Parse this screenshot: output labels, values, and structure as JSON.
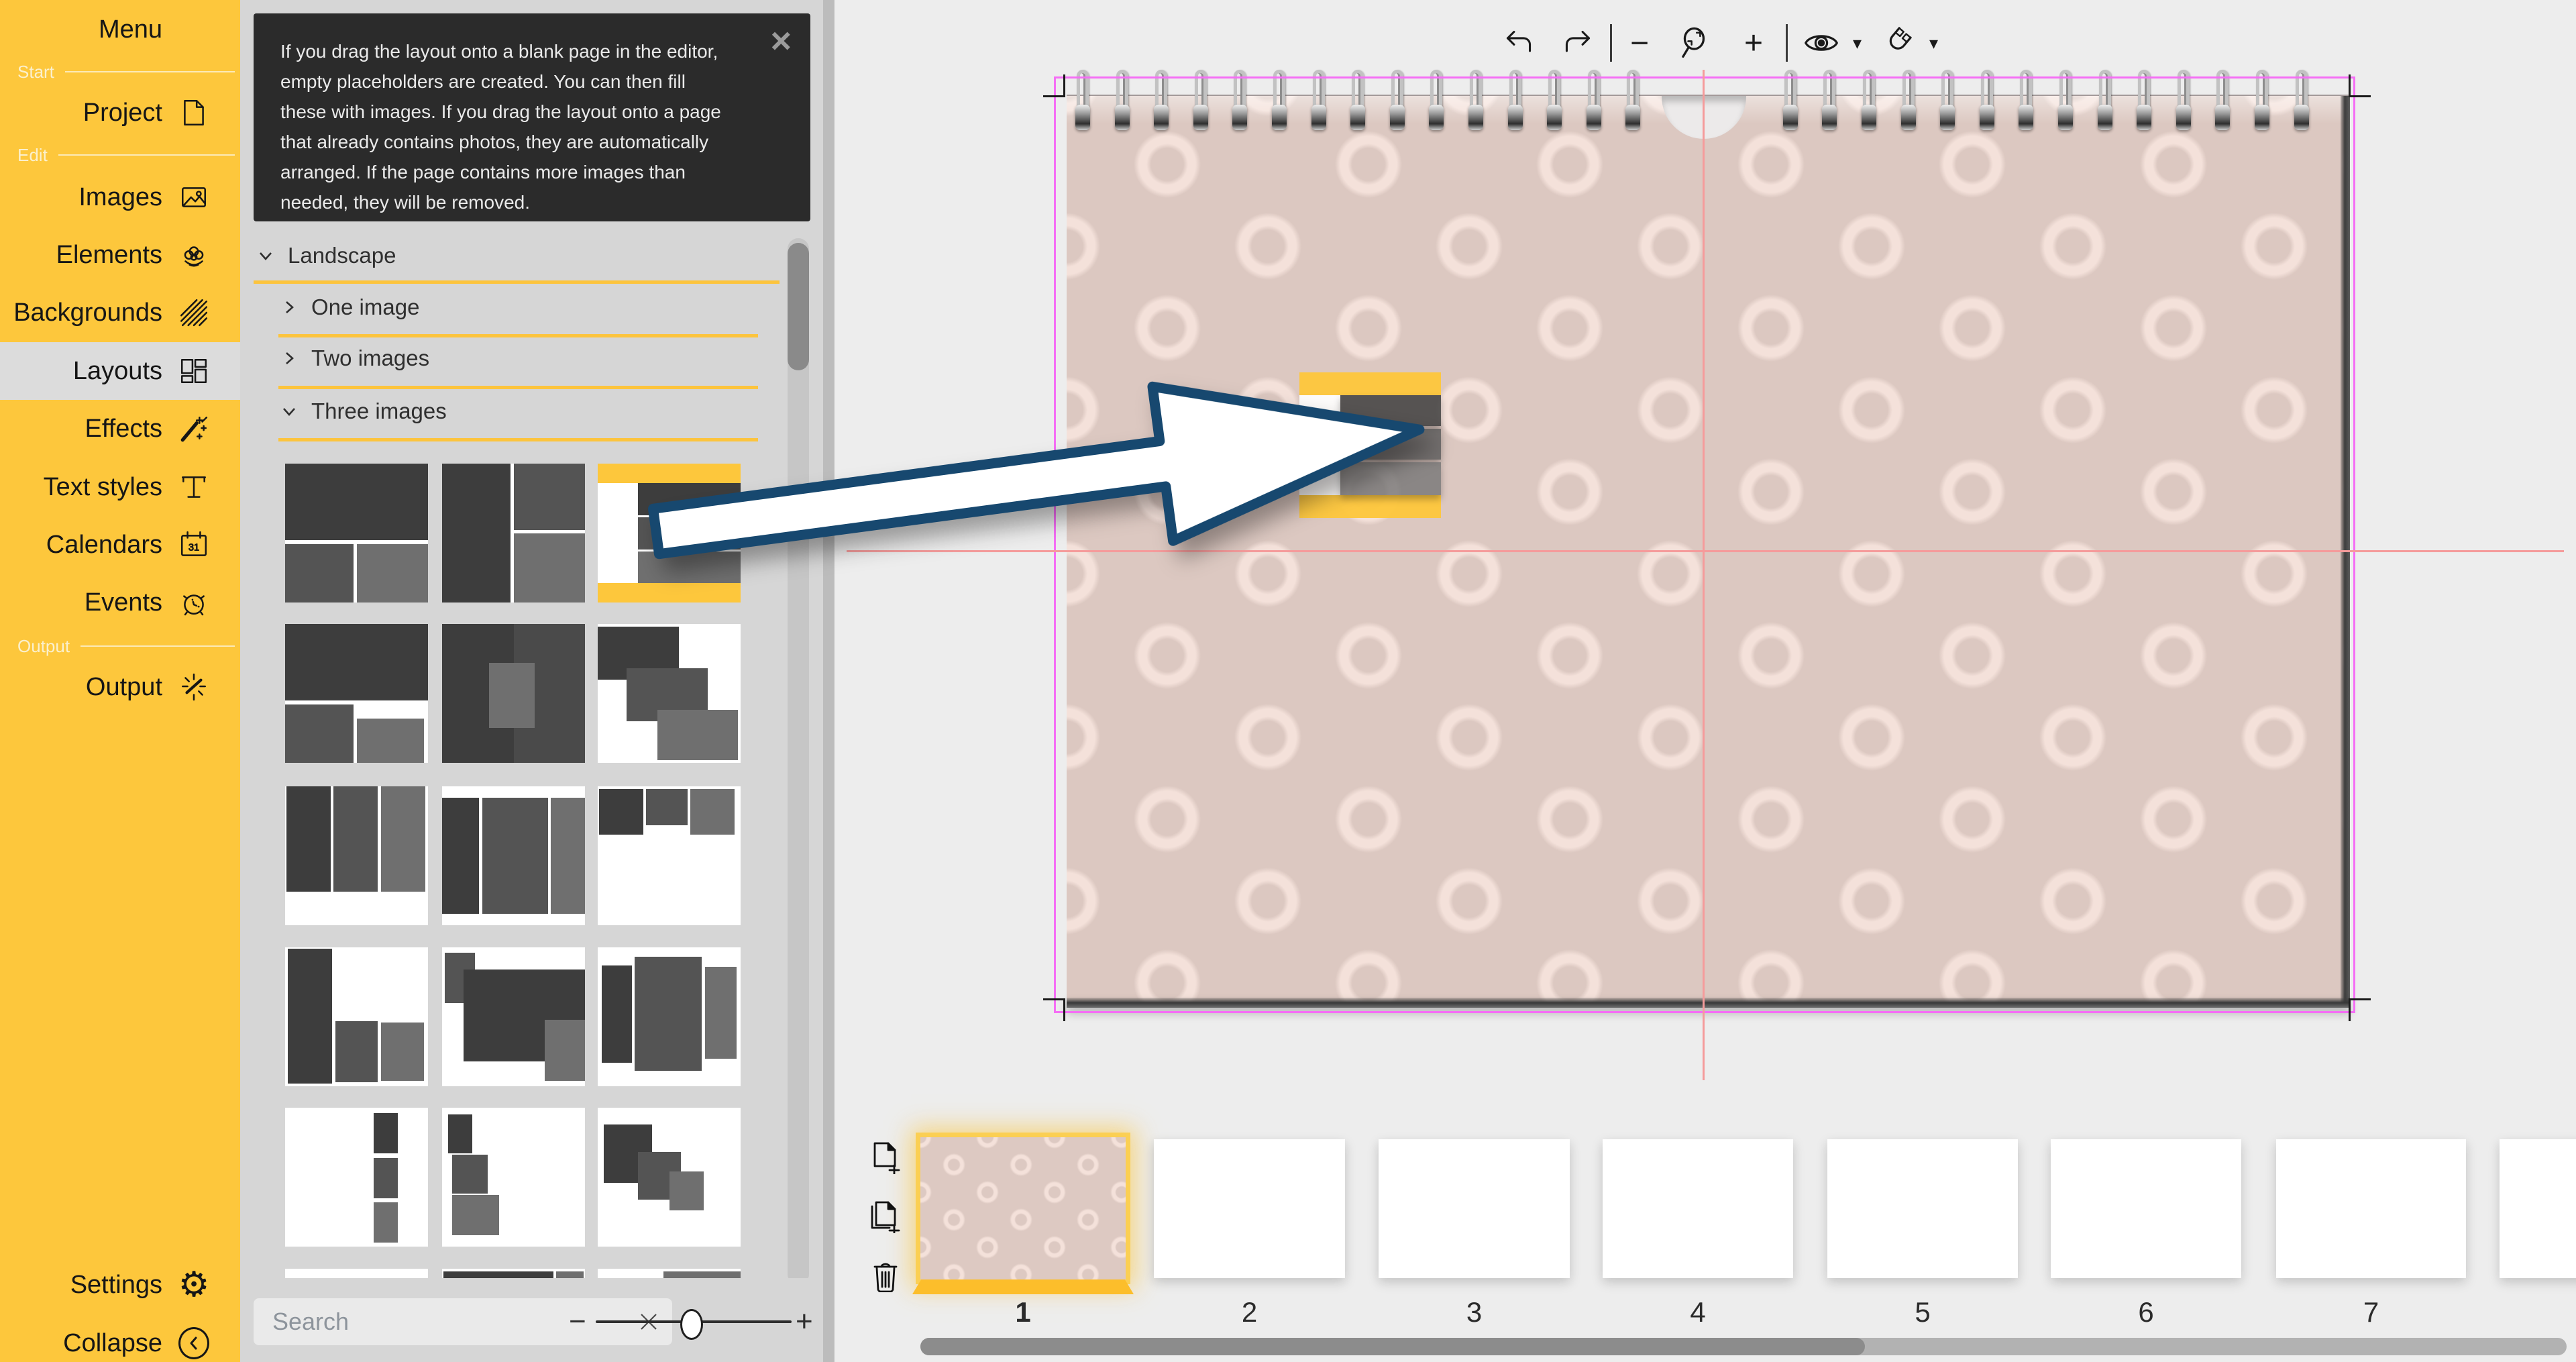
{
  "sidebar": {
    "menu": {
      "label": "Menu"
    },
    "sections": {
      "start": "Start",
      "edit": "Edit",
      "output": "Output"
    },
    "items": [
      {
        "label": "Project",
        "icon": "document-icon"
      },
      {
        "label": "Images",
        "icon": "image-icon"
      },
      {
        "label": "Elements",
        "icon": "flower-icon"
      },
      {
        "label": "Backgrounds",
        "icon": "hatch-icon"
      },
      {
        "label": "Layouts",
        "icon": "layout-grid-icon",
        "selected": true
      },
      {
        "label": "Effects",
        "icon": "magic-wand-icon"
      },
      {
        "label": "Text styles",
        "icon": "serif-t-icon"
      },
      {
        "label": "Calendars",
        "icon": "calendar-icon"
      },
      {
        "label": "Events",
        "icon": "alarm-clock-icon"
      },
      {
        "label": "Output",
        "icon": "spark-icon"
      }
    ],
    "footer": [
      {
        "label": "Settings",
        "icon": "gear-icon"
      },
      {
        "label": "Collapse",
        "icon": "collapse-icon"
      }
    ],
    "accent_color": "#fdc73c"
  },
  "tooltip": {
    "text": "If you drag the layout onto a blank page in the editor, empty placeholders are created. You can then fill these with images. If you drag the layout onto a page that already contains photos, they are automatically arranged. If the page contains more images than needed, they will be removed.",
    "close": "×"
  },
  "layouts_panel": {
    "category": {
      "label": "Landscape",
      "expanded": true
    },
    "subcategories": [
      {
        "label": "One image",
        "expanded": false
      },
      {
        "label": "Two images",
        "expanded": false
      },
      {
        "label": "Three images",
        "expanded": true
      }
    ],
    "search": {
      "placeholder": "Search"
    },
    "zoom_minus": "−",
    "zoom_plus": "+"
  },
  "toolbar": {
    "zoom_out": "−",
    "zoom_in": "+",
    "icons": [
      "undo",
      "redo",
      "zoom-out",
      "zoom-fit",
      "zoom-in",
      "visibility",
      "snap"
    ]
  },
  "canvas": {
    "page_color": "#dcc8c1",
    "pattern_ring_color": "#f4e1da",
    "guide_magenta": "#f56ef5",
    "guide_center": "#f59b9b",
    "selected_layout_accent": "#fdc73c",
    "arrow_outline": "#17486f"
  },
  "filmstrip": {
    "pages": [
      {
        "number": "1",
        "selected": true
      },
      {
        "number": "2"
      },
      {
        "number": "3"
      },
      {
        "number": "4"
      },
      {
        "number": "5"
      },
      {
        "number": "6"
      },
      {
        "number": "7"
      },
      {
        "number": ""
      }
    ]
  }
}
